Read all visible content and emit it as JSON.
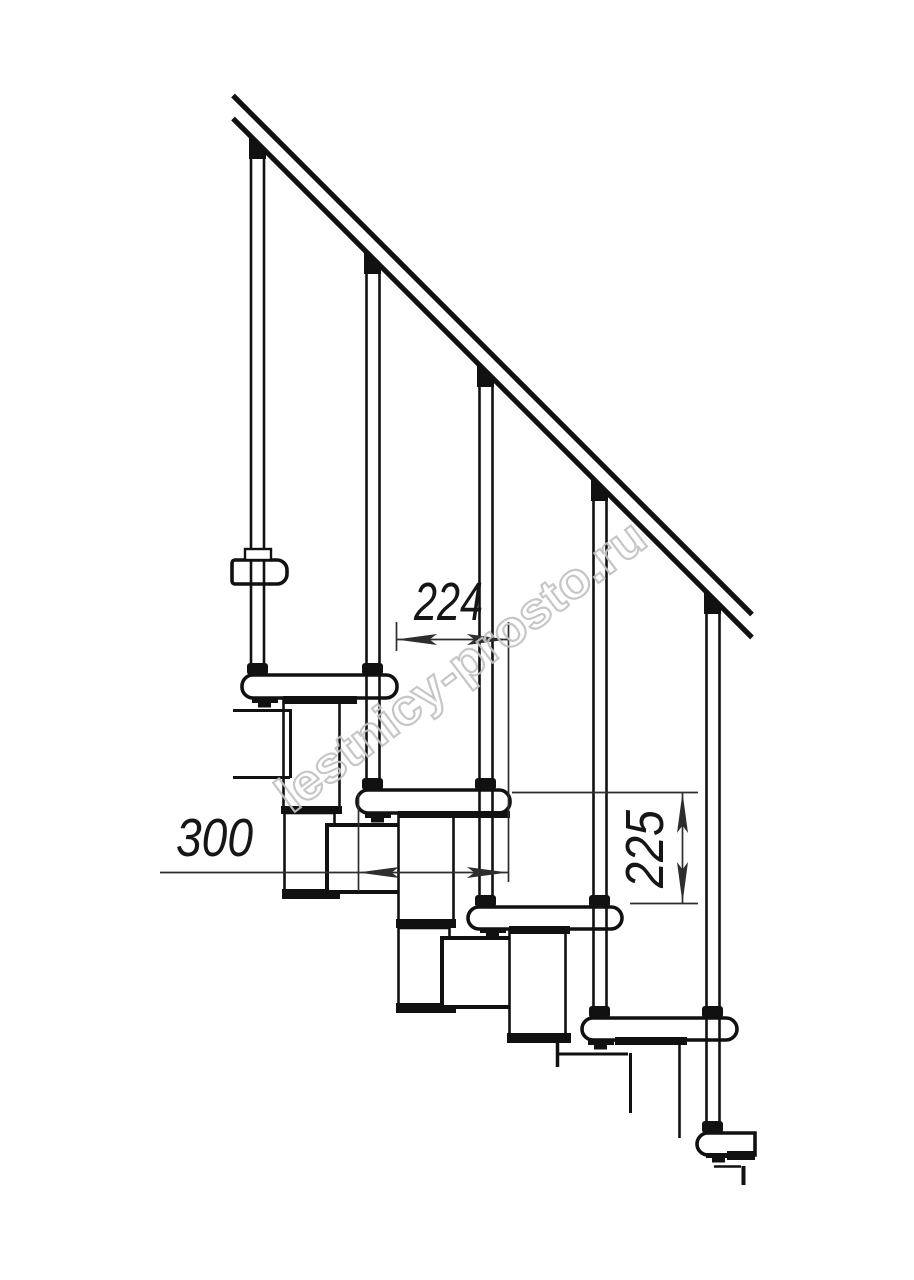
{
  "dimensions": {
    "step_run": "224",
    "tread_depth": "300",
    "step_rise": "225"
  },
  "watermark": "lestnicy-prosto.ru",
  "colors": {
    "ink": "#111111",
    "dimension": "#2e2e2e",
    "watermark": "#c2c2c2",
    "background": "#ffffff"
  }
}
